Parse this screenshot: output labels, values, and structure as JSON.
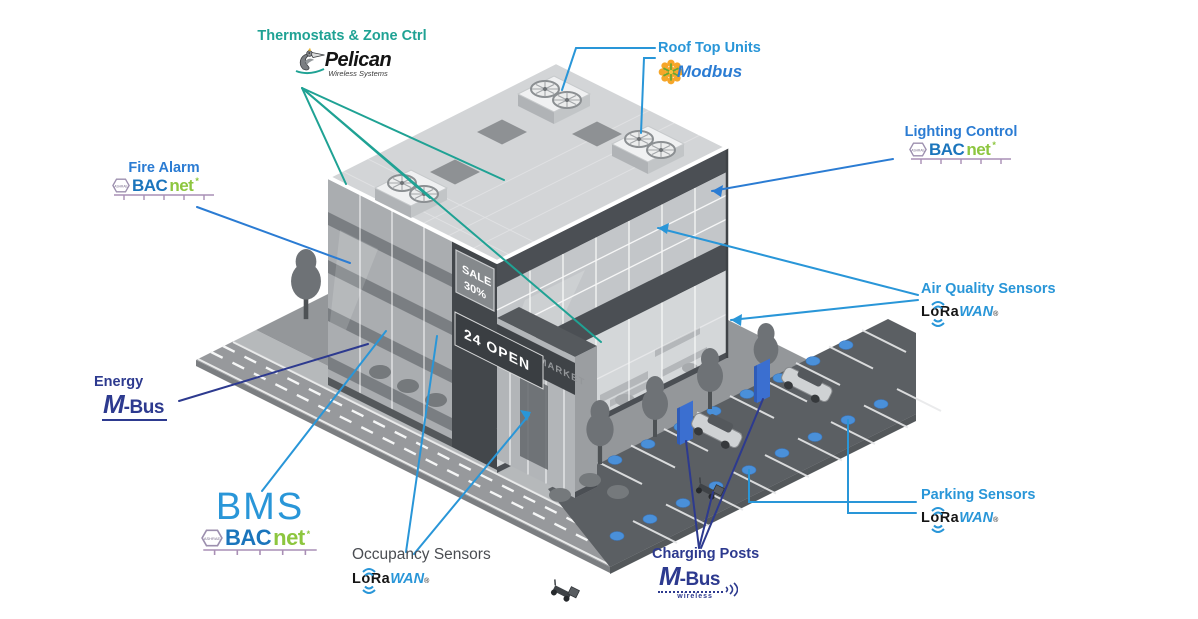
{
  "colors": {
    "teal": "#1FA294",
    "label_blue": "#2B7CD3",
    "light_blue": "#2996D8",
    "navy": "#2D3A8F",
    "occupancy_gray": "#4A4D52",
    "bacnet_blue": "#1B75BC",
    "bacnet_green": "#8DC63F",
    "bacnet_line": "#A98FB5",
    "lora_blue": "#2996D8",
    "modbus_blue": "#2B7CD3",
    "modbus_orange": "#F6A21E",
    "modbus_green": "#69A832",
    "dot_blue": "#4A90D9",
    "post_blue": "#3B6FD0"
  },
  "annotations": {
    "thermostats": {
      "label": "Thermostats & Zone Ctrl"
    },
    "rooftop_units": {
      "label": "Roof Top Units"
    },
    "lighting_control": {
      "label": "Lighting Control"
    },
    "fire_alarm": {
      "label": "Fire Alarm"
    },
    "air_quality": {
      "label": "Air Quality Sensors"
    },
    "energy": {
      "label": "Energy"
    },
    "bms": {
      "label": "BMS"
    },
    "occupancy": {
      "label": "Occupancy Sensors"
    },
    "parking": {
      "label": "Parking Sensors"
    },
    "charging_posts": {
      "label": "Charging Posts"
    }
  },
  "logos": {
    "pelican": {
      "name": "Pelican",
      "tagline": "Wireless Systems"
    },
    "modbus": {
      "name": "Modbus"
    },
    "bacnet": {
      "prefix": "BAC",
      "suffix": "net",
      "mark": "*",
      "badge": "ASHRAE"
    },
    "lorawan": {
      "prefix": "LoRa",
      "suffix": "WAN",
      "mark": "®"
    },
    "mbus": {
      "m": "M",
      "rest": "-Bus",
      "tagline": "wireless"
    }
  },
  "building": {
    "sale_line1": "SALE",
    "sale_line2": "30%",
    "open_sign": "24 OPEN",
    "fascia_sign": "SUPERMARKET"
  }
}
